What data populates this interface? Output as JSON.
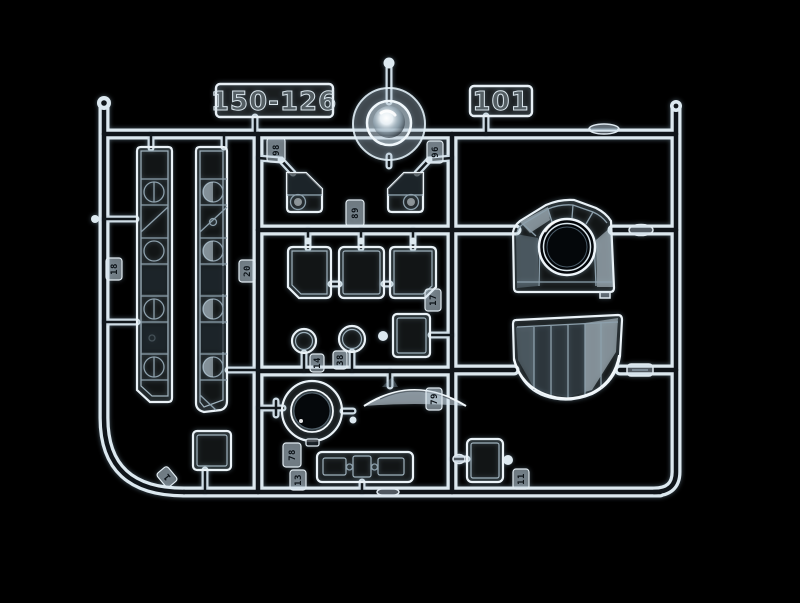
{
  "labels": {
    "mold_number": "150-126",
    "sprue_code": "101"
  },
  "part_tags": {
    "v1_top": "98",
    "frame_left": "18",
    "v1_left": "20",
    "center_runner": "89",
    "v2_top": "96",
    "lens_left": "14",
    "lens_right": "38",
    "v2_mid": "17",
    "v2_lower": "79",
    "v1_bottom": "78",
    "window_strip": "13",
    "square_frame": "11",
    "bottom_curve": "1"
  },
  "colors": {
    "background": "#000000",
    "plastic_bright": "#eef5f9",
    "plastic_mid": "#9fb2bd",
    "plastic_dim": "#4f5e68",
    "highlight": "#ffffff"
  }
}
